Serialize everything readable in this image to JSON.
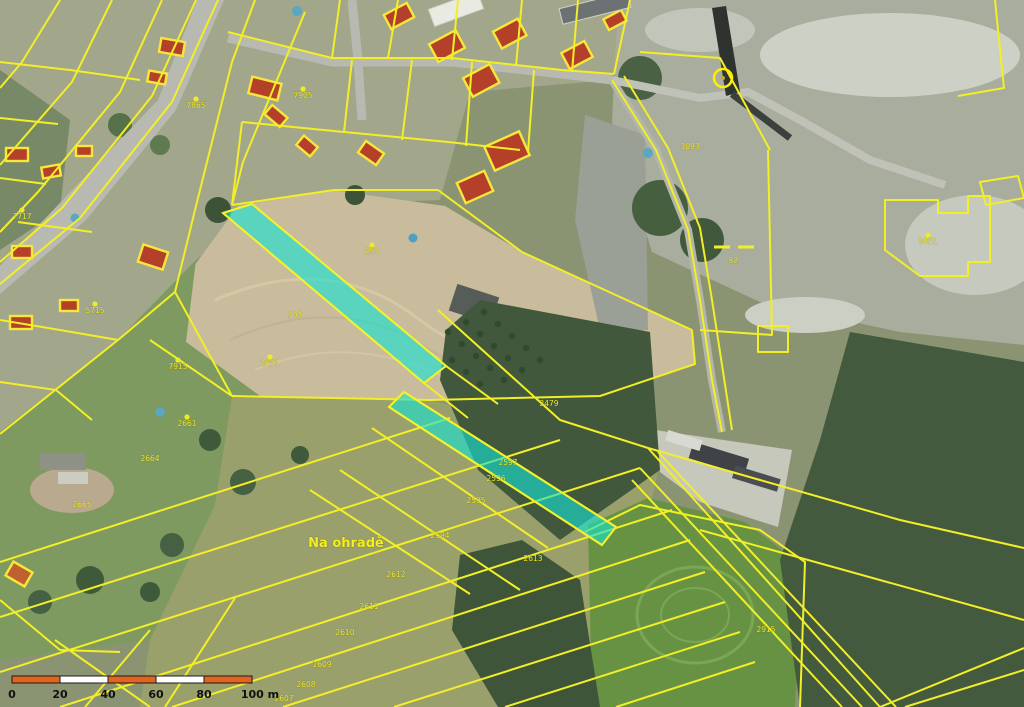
{
  "map": {
    "type": "cadastral-aerial-map",
    "place_label": "Na ohradě",
    "colors": {
      "parcel_line": "#f2ee28",
      "highlight_fill": "rgba(22,226,212,0.62)",
      "highlight_edge": "#f6f22a",
      "label_yellow": "#efe92c"
    },
    "highlighted_parcels": [
      {
        "name": "highlighted-strip-1",
        "points": "252,204 446,366 424,383 223,213"
      },
      {
        "name": "highlighted-strip-2",
        "points": "404,392 616,527 602,545 389,407"
      }
    ],
    "parcel_numbers": [
      {
        "text": "7865",
        "x": 196,
        "y": 108,
        "dot": true
      },
      {
        "text": "7905",
        "x": 303,
        "y": 98,
        "dot": true
      },
      {
        "text": "7717",
        "x": 22,
        "y": 219,
        "dot": true
      },
      {
        "text": "5715",
        "x": 95,
        "y": 313,
        "dot": true
      },
      {
        "text": "7915",
        "x": 178,
        "y": 369,
        "dot": true
      },
      {
        "text": "253",
        "x": 372,
        "y": 254,
        "dot": true
      },
      {
        "text": "2631",
        "x": 270,
        "y": 366,
        "dot": true
      },
      {
        "text": "2661",
        "x": 187,
        "y": 426,
        "dot": true
      },
      {
        "text": "2664",
        "x": 150,
        "y": 461,
        "dot": false
      },
      {
        "text": "2665",
        "x": 82,
        "y": 507,
        "dot": false
      },
      {
        "text": "303",
        "x": 295,
        "y": 318,
        "dot": false
      },
      {
        "text": "3093",
        "x": 690,
        "y": 149,
        "dot": false
      },
      {
        "text": "3051",
        "x": 928,
        "y": 244,
        "dot": true
      },
      {
        "text": "92",
        "x": 733,
        "y": 263,
        "dot": false
      },
      {
        "text": "2479",
        "x": 549,
        "y": 406,
        "dot": false
      },
      {
        "text": "2597",
        "x": 508,
        "y": 465,
        "dot": false
      },
      {
        "text": "2596",
        "x": 496,
        "y": 481,
        "dot": false
      },
      {
        "text": "2595",
        "x": 476,
        "y": 503,
        "dot": false
      },
      {
        "text": "2594",
        "x": 440,
        "y": 538,
        "dot": false
      },
      {
        "text": "2613",
        "x": 533,
        "y": 561,
        "dot": false
      },
      {
        "text": "2612",
        "x": 396,
        "y": 577,
        "dot": false
      },
      {
        "text": "2611",
        "x": 369,
        "y": 609,
        "dot": false
      },
      {
        "text": "2610",
        "x": 345,
        "y": 635,
        "dot": false
      },
      {
        "text": "2609",
        "x": 322,
        "y": 667,
        "dot": false
      },
      {
        "text": "2608",
        "x": 306,
        "y": 687,
        "dot": false
      },
      {
        "text": "2607",
        "x": 284,
        "y": 701,
        "dot": false
      },
      {
        "text": "2915",
        "x": 766,
        "y": 632,
        "dot": false
      }
    ],
    "landmark_marker": {
      "name": "chimney-circle-marker",
      "x": 723,
      "y": 78,
      "r": 9
    }
  },
  "scale_bar": {
    "x": 12,
    "y": 676,
    "height": 7,
    "segments": 5,
    "segment_width": 48,
    "color_a": "#e2641f",
    "color_b": "#ffffff",
    "outline": "#1a1a1a",
    "labels": [
      "0",
      "20",
      "40",
      "60",
      "80"
    ],
    "end_label": "100 m",
    "label_y": 698
  }
}
